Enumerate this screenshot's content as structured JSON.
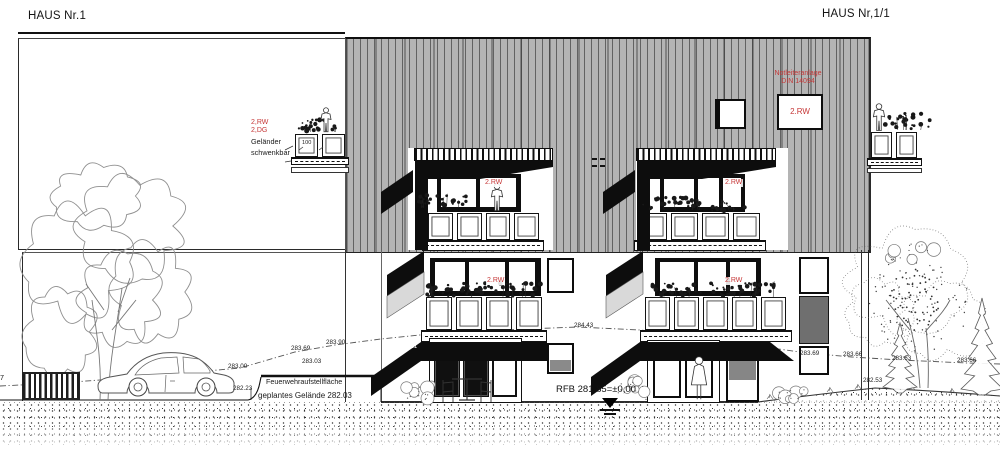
{
  "titles": {
    "left": "HAUS Nr.1",
    "right": "HAUS Nr,1/1"
  },
  "neighbor_note": {
    "rw": "2,RW",
    "floor": "2,DG",
    "l1": "Geländer",
    "l2": "schwenkbar",
    "dim": "100"
  },
  "notleiter": {
    "l1": "Notleiteranlage",
    "l2": "DIN 14094",
    "box": "2.RW"
  },
  "rw_labels": {
    "dormer_left": "2.RW",
    "og_left": "2.RW",
    "dormer_right": "2.RW",
    "og_right": "2.RW"
  },
  "datum": {
    "rfb": "RFB 281,85=±0,00"
  },
  "ground_labels": {
    "fire_area": "Feuerwehraufstellfläche",
    "planned_ground": "geplantes Gelände 282.03",
    "left_edge_cut": "7"
  },
  "elevation_markers": [
    {
      "text": "283.00",
      "x": 228,
      "y": 363
    },
    {
      "text": "282.23",
      "x": 233,
      "y": 385
    },
    {
      "text": "283.69",
      "x": 291,
      "y": 345
    },
    {
      "text": "283.03",
      "x": 302,
      "y": 358
    },
    {
      "text": "283.90",
      "x": 326,
      "y": 339
    },
    {
      "text": "284.21",
      "x": 398,
      "y": 343,
      "white": true
    },
    {
      "text": "284.43",
      "x": 574,
      "y": 322
    },
    {
      "text": "283.69",
      "x": 800,
      "y": 350
    },
    {
      "text": "283.66",
      "x": 843,
      "y": 351
    },
    {
      "text": "282.53",
      "x": 863,
      "y": 377
    },
    {
      "text": "283.63",
      "x": 892,
      "y": 355
    },
    {
      "text": "283.66",
      "x": 957,
      "y": 357
    }
  ],
  "colors": {
    "annotation_red": "#c63838",
    "roof_gray": "#b4b4b4",
    "panel_gray": "#6f6f6f",
    "shadow_black": "#0d0d0d",
    "balcony_side_gray": "#d9d9d9"
  }
}
